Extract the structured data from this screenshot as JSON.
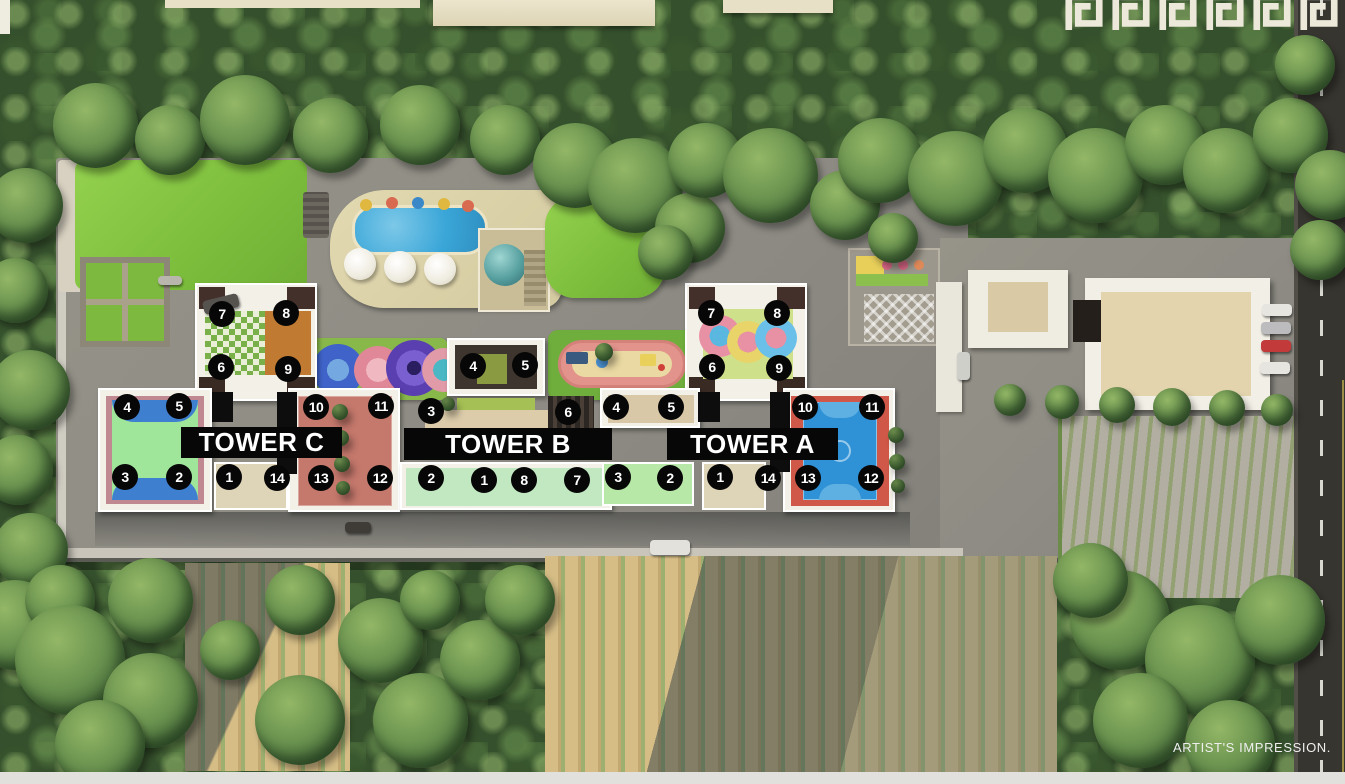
{
  "scene": {
    "title": "Residential complex master plan - aerial artist's impression",
    "credit": "ARTIST'S IMPRESSION."
  },
  "towers": [
    {
      "id": "tower-c",
      "label": "TOWER C",
      "label_bar": {
        "x": 181,
        "y": 427,
        "w": 161,
        "h": 31
      },
      "markers": [
        {
          "n": "7",
          "x": 222,
          "y": 314
        },
        {
          "n": "8",
          "x": 286,
          "y": 313
        },
        {
          "n": "6",
          "x": 221,
          "y": 367
        },
        {
          "n": "9",
          "x": 288,
          "y": 369
        },
        {
          "n": "4",
          "x": 127,
          "y": 407
        },
        {
          "n": "5",
          "x": 179,
          "y": 406
        },
        {
          "n": "10",
          "x": 316,
          "y": 407
        },
        {
          "n": "11",
          "x": 381,
          "y": 406
        },
        {
          "n": "3",
          "x": 125,
          "y": 477
        },
        {
          "n": "2",
          "x": 179,
          "y": 477
        },
        {
          "n": "1",
          "x": 229,
          "y": 477
        },
        {
          "n": "14",
          "x": 277,
          "y": 478
        },
        {
          "n": "13",
          "x": 321,
          "y": 478
        },
        {
          "n": "12",
          "x": 380,
          "y": 478
        }
      ]
    },
    {
      "id": "tower-b",
      "label": "TOWER B",
      "label_bar": {
        "x": 404,
        "y": 428,
        "w": 208,
        "h": 32
      },
      "markers": [
        {
          "n": "4",
          "x": 473,
          "y": 366
        },
        {
          "n": "5",
          "x": 525,
          "y": 365
        },
        {
          "n": "3",
          "x": 431,
          "y": 411
        },
        {
          "n": "6",
          "x": 568,
          "y": 412
        },
        {
          "n": "2",
          "x": 431,
          "y": 478
        },
        {
          "n": "1",
          "x": 484,
          "y": 480
        },
        {
          "n": "8",
          "x": 524,
          "y": 480
        },
        {
          "n": "7",
          "x": 577,
          "y": 480
        }
      ]
    },
    {
      "id": "tower-a",
      "label": "TOWER A",
      "label_bar": {
        "x": 667,
        "y": 428,
        "w": 171,
        "h": 32
      },
      "markers": [
        {
          "n": "7",
          "x": 711,
          "y": 313
        },
        {
          "n": "8",
          "x": 777,
          "y": 313
        },
        {
          "n": "6",
          "x": 712,
          "y": 367
        },
        {
          "n": "9",
          "x": 779,
          "y": 368
        },
        {
          "n": "4",
          "x": 616,
          "y": 407
        },
        {
          "n": "5",
          "x": 671,
          "y": 407
        },
        {
          "n": "10",
          "x": 805,
          "y": 407
        },
        {
          "n": "11",
          "x": 872,
          "y": 407
        },
        {
          "n": "3",
          "x": 618,
          "y": 477
        },
        {
          "n": "2",
          "x": 670,
          "y": 478
        },
        {
          "n": "1",
          "x": 720,
          "y": 477
        },
        {
          "n": "14",
          "x": 768,
          "y": 478
        },
        {
          "n": "13",
          "x": 808,
          "y": 478
        },
        {
          "n": "12",
          "x": 871,
          "y": 478
        }
      ]
    }
  ],
  "decor": {
    "border_pattern": "greek-key",
    "tile_count": 6
  },
  "palette": {
    "marker_bg": "#070707",
    "marker_text": "#ffffff",
    "label_bg": "#070707",
    "label_text": "#ffffff",
    "pool_blue": "#3aa6d8",
    "lawn_green": "#7fc241",
    "track_pink": "#e2938c",
    "court_blue": "#2f92d6",
    "court_terracotta": "#c5786c",
    "road_asphalt": "#37352f"
  }
}
